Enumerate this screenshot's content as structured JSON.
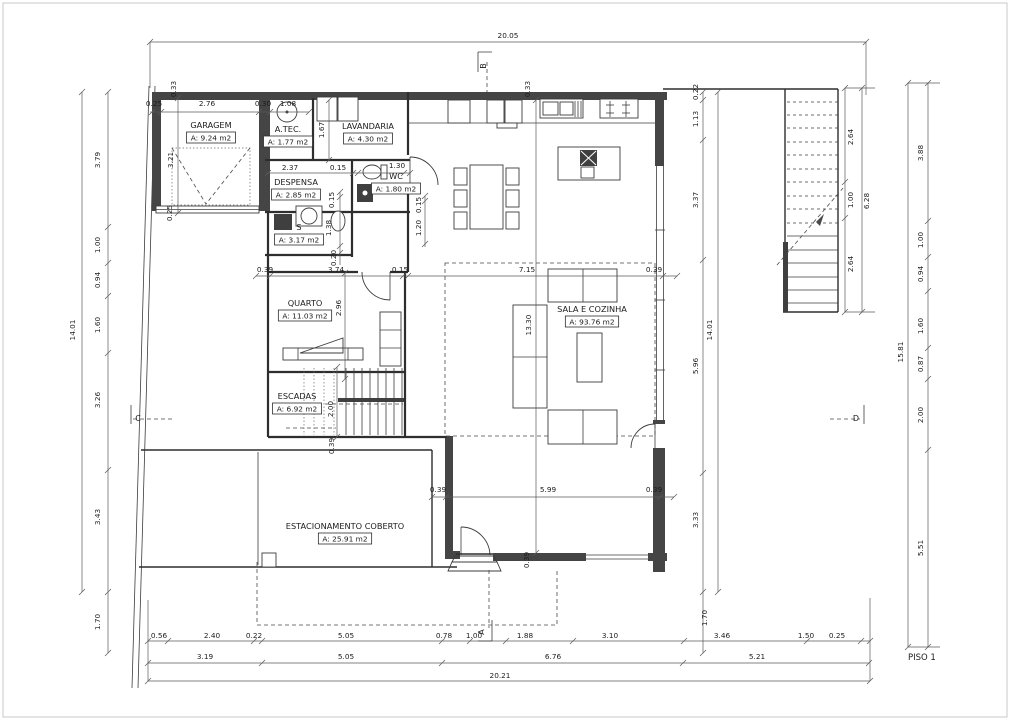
{
  "drawing_label": "PISO 1",
  "rooms": [
    {
      "name": "GARAGEM",
      "area": "A: 9.24 m2",
      "x": 211,
      "y": 128
    },
    {
      "name": "A.TEC.",
      "area": "A: 1.77 m2",
      "x": 288,
      "y": 132
    },
    {
      "name": "LAVANDARIA",
      "area": "A: 4.30 m2",
      "x": 368,
      "y": 129
    },
    {
      "name": "DESPENSA",
      "area": "A: 2.85 m2",
      "x": 296,
      "y": 185
    },
    {
      "name": "WC",
      "area": "A: 1.80 m2",
      "x": 396,
      "y": 179
    },
    {
      "name": "S",
      "area": "A: 3.17 m2",
      "x": 299,
      "y": 230
    },
    {
      "name": "QUARTO",
      "area": "A: 11.03 m2",
      "x": 305,
      "y": 306
    },
    {
      "name": "ESCADAS",
      "area": "A: 6.92 m2",
      "x": 297,
      "y": 399
    },
    {
      "name": "SALA E COZINHA",
      "area": "A: 93.76 m2",
      "x": 592,
      "y": 312
    },
    {
      "name": "ESTACIONAMENTO COBERTO",
      "area": "A: 25.91 m2",
      "x": 345,
      "y": 529
    }
  ],
  "section_markers": [
    {
      "label": "B",
      "x": 486,
      "y": 66,
      "rot": true
    },
    {
      "label": "A",
      "x": 484,
      "y": 632,
      "rot": true
    },
    {
      "label": "C",
      "x": 138,
      "y": 421,
      "rot": false
    },
    {
      "label": "D",
      "x": 856,
      "y": 421,
      "rot": false
    }
  ],
  "dimensions": [
    {
      "t": "20.05",
      "x": 508,
      "y": 38,
      "r": 0
    },
    {
      "t": "0.33",
      "x": 176,
      "y": 89,
      "r": 1
    },
    {
      "t": "0.33",
      "x": 530,
      "y": 89,
      "r": 1
    },
    {
      "t": "0.22",
      "x": 698,
      "y": 92,
      "r": 1
    },
    {
      "t": "1.13",
      "x": 698,
      "y": 119,
      "r": 1
    },
    {
      "t": "0.25",
      "x": 154,
      "y": 106,
      "r": 0
    },
    {
      "t": "2.76",
      "x": 207,
      "y": 106,
      "r": 0
    },
    {
      "t": "0.30",
      "x": 263,
      "y": 106,
      "r": 0
    },
    {
      "t": "1.08",
      "x": 288,
      "y": 106,
      "r": 0
    },
    {
      "t": "1.67",
      "x": 324,
      "y": 130,
      "r": 1
    },
    {
      "t": "3.21",
      "x": 173,
      "y": 160,
      "r": 1
    },
    {
      "t": "0.25",
      "x": 172,
      "y": 213,
      "r": 1
    },
    {
      "t": "2.37",
      "x": 290,
      "y": 170,
      "r": 0
    },
    {
      "t": "0.15",
      "x": 338,
      "y": 170,
      "r": 0
    },
    {
      "t": "1.30",
      "x": 397,
      "y": 168,
      "r": 0
    },
    {
      "t": "0.15",
      "x": 421,
      "y": 205,
      "r": 1
    },
    {
      "t": "1.20",
      "x": 421,
      "y": 228,
      "r": 1
    },
    {
      "t": "0.15",
      "x": 334,
      "y": 200,
      "r": 1
    },
    {
      "t": "1.38",
      "x": 331,
      "y": 228,
      "r": 1
    },
    {
      "t": "0.20",
      "x": 336,
      "y": 258,
      "r": 1
    },
    {
      "t": "0.39",
      "x": 265,
      "y": 272,
      "r": 0
    },
    {
      "t": "3.74",
      "x": 336,
      "y": 272,
      "r": 0
    },
    {
      "t": "0.15",
      "x": 400,
      "y": 272,
      "r": 0
    },
    {
      "t": "7.15",
      "x": 527,
      "y": 272,
      "r": 0
    },
    {
      "t": "0.39",
      "x": 654,
      "y": 272,
      "r": 0
    },
    {
      "t": "2.96",
      "x": 341,
      "y": 308,
      "r": 1
    },
    {
      "t": "13.30",
      "x": 531,
      "y": 325,
      "r": 1
    },
    {
      "t": "2.00",
      "x": 333,
      "y": 409,
      "r": 1
    },
    {
      "t": "0.39",
      "x": 334,
      "y": 446,
      "r": 1
    },
    {
      "t": "0.39",
      "x": 438,
      "y": 492,
      "r": 0
    },
    {
      "t": "5.99",
      "x": 548,
      "y": 492,
      "r": 0
    },
    {
      "t": "0.39",
      "x": 654,
      "y": 492,
      "r": 0
    },
    {
      "t": "0.39",
      "x": 529,
      "y": 560,
      "r": 1
    },
    {
      "t": "3.79",
      "x": 100,
      "y": 160,
      "r": 1
    },
    {
      "t": "1.00",
      "x": 100,
      "y": 245,
      "r": 1
    },
    {
      "t": "0.94",
      "x": 100,
      "y": 280,
      "r": 1
    },
    {
      "t": "1.60",
      "x": 100,
      "y": 325,
      "r": 1
    },
    {
      "t": "3.26",
      "x": 100,
      "y": 400,
      "r": 1
    },
    {
      "t": "3.43",
      "x": 100,
      "y": 517,
      "r": 1
    },
    {
      "t": "1.70",
      "x": 100,
      "y": 622,
      "r": 1
    },
    {
      "t": "14.01",
      "x": 75,
      "y": 330,
      "r": 1
    },
    {
      "t": "3.37",
      "x": 698,
      "y": 200,
      "r": 1
    },
    {
      "t": "5.96",
      "x": 698,
      "y": 366,
      "r": 1
    },
    {
      "t": "3.33",
      "x": 698,
      "y": 520,
      "r": 1
    },
    {
      "t": "1.70",
      "x": 707,
      "y": 618,
      "r": 1
    },
    {
      "t": "14.01",
      "x": 712,
      "y": 330,
      "r": 1
    },
    {
      "t": "2.64",
      "x": 853,
      "y": 137,
      "r": 1
    },
    {
      "t": "1.00",
      "x": 853,
      "y": 200,
      "r": 1
    },
    {
      "t": "2.64",
      "x": 853,
      "y": 264,
      "r": 1
    },
    {
      "t": "6.28",
      "x": 869,
      "y": 201,
      "r": 1
    },
    {
      "t": "3.88",
      "x": 923,
      "y": 153,
      "r": 1
    },
    {
      "t": "1.00",
      "x": 923,
      "y": 240,
      "r": 1
    },
    {
      "t": "0.94",
      "x": 923,
      "y": 274,
      "r": 1
    },
    {
      "t": "1.60",
      "x": 923,
      "y": 326,
      "r": 1
    },
    {
      "t": "0.87",
      "x": 923,
      "y": 364,
      "r": 1
    },
    {
      "t": "2.00",
      "x": 923,
      "y": 415,
      "r": 1
    },
    {
      "t": "5.51",
      "x": 923,
      "y": 548,
      "r": 1
    },
    {
      "t": "15.81",
      "x": 903,
      "y": 352,
      "r": 1
    },
    {
      "t": "0.56",
      "x": 159,
      "y": 638,
      "r": 0
    },
    {
      "t": "2.40",
      "x": 212,
      "y": 638,
      "r": 0
    },
    {
      "t": "0.22",
      "x": 254,
      "y": 638,
      "r": 0
    },
    {
      "t": "5.05",
      "x": 346,
      "y": 638,
      "r": 0
    },
    {
      "t": "0.78",
      "x": 444,
      "y": 638,
      "r": 0
    },
    {
      "t": "1.00",
      "x": 474,
      "y": 638,
      "r": 0
    },
    {
      "t": "1.88",
      "x": 525,
      "y": 638,
      "r": 0
    },
    {
      "t": "3.10",
      "x": 610,
      "y": 638,
      "r": 0
    },
    {
      "t": "3.46",
      "x": 722,
      "y": 638,
      "r": 0
    },
    {
      "t": "1.50",
      "x": 806,
      "y": 638,
      "r": 0
    },
    {
      "t": "0.25",
      "x": 837,
      "y": 638,
      "r": 0
    },
    {
      "t": "3.19",
      "x": 205,
      "y": 659,
      "r": 0
    },
    {
      "t": "5.05",
      "x": 346,
      "y": 659,
      "r": 0
    },
    {
      "t": "6.76",
      "x": 553,
      "y": 659,
      "r": 0
    },
    {
      "t": "5.21",
      "x": 757,
      "y": 659,
      "r": 0
    },
    {
      "t": "20.21",
      "x": 500,
      "y": 678,
      "r": 0
    }
  ]
}
